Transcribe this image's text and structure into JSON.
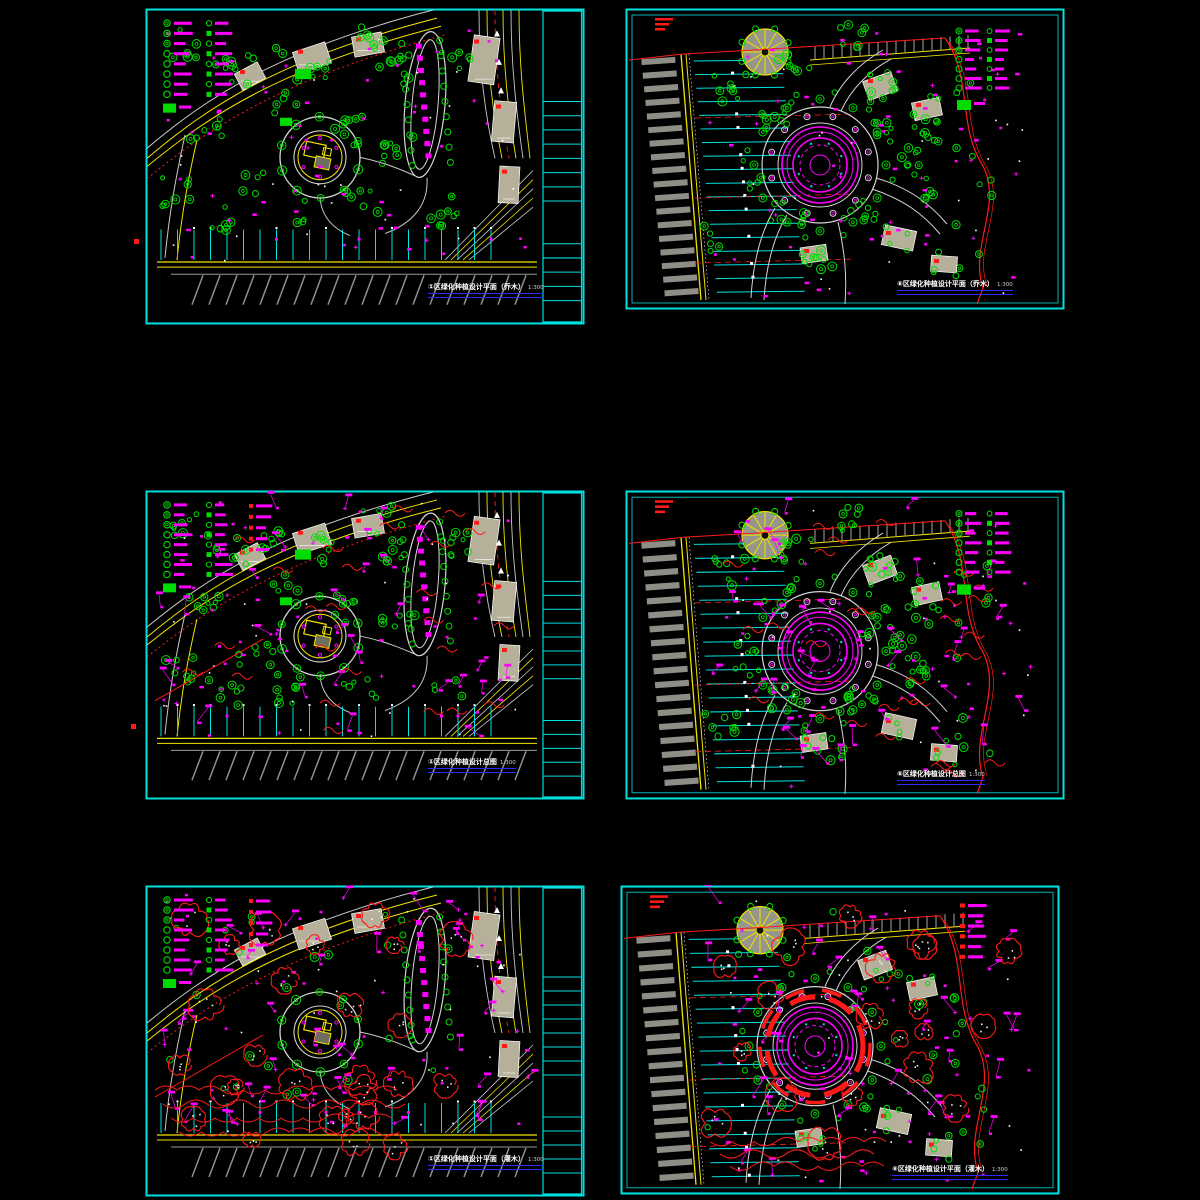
{
  "sheet": {
    "description_visible_panels": 6
  },
  "colors": {
    "frame": "#00e0e0",
    "road_center": "#f2e400",
    "road_edge": "#c9c9c9",
    "vegetation": "#00dc00",
    "annotation": "#ff00ff",
    "shrub": "#ff1a1a",
    "building": "#b6b09a",
    "underline": "#2a2aff",
    "title_text": "#ffffff"
  },
  "panels": [
    {
      "id": "zone1-trees",
      "title": "①区绿化种植设计平面（乔木）",
      "scale": "1:300"
    },
    {
      "id": "zone6-trees",
      "title": "⑥区绿化种植设计平面（乔木）",
      "scale": "1:300"
    },
    {
      "id": "zone1-overall",
      "title": "①区绿化种植设计总图",
      "scale": "1:300"
    },
    {
      "id": "zone6-overall",
      "title": "⑥区绿化种植设计总图",
      "scale": "1:300"
    },
    {
      "id": "zone1-shrubs",
      "title": "①区绿化种植设计平面（灌木）",
      "scale": "1:300"
    },
    {
      "id": "zone6-shrubs",
      "title": "⑥区绿化种植设计平面（灌木）",
      "scale": "1:300"
    }
  ],
  "legend": {
    "left_panel_rows": 8,
    "right_panel_rows": 7,
    "shrub_legend_rows": 6
  }
}
